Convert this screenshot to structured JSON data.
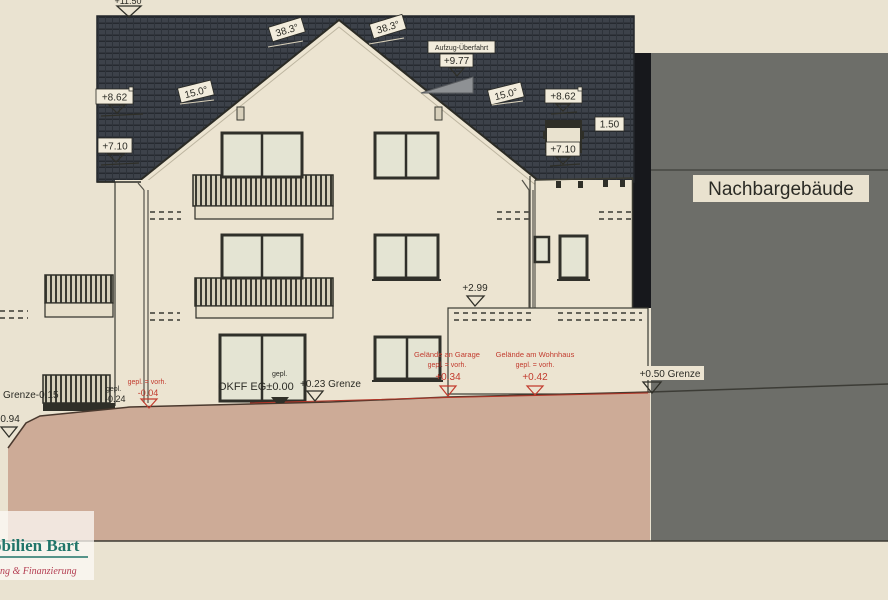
{
  "drawing_labels": {
    "ridge_level": "+11.50",
    "left_roof_level_upper": "+8.62",
    "left_roof_pitch": "15.0°",
    "left_roof_level_lower": "+7.10",
    "gable_angle_left": "38.3°",
    "gable_angle_right": "38.3°",
    "elevator_label": "Aufzug-Überfahrt",
    "elevator_level": "+9.77",
    "right_roof_pitch": "15.0°",
    "right_roof_level_upper": "+8.62",
    "right_roof_width": "1.50",
    "right_roof_level_lower": "+7.10",
    "neighbor_building": "Nachbargebäude",
    "garage_roof_level": "+2.99"
  },
  "ground_labels": {
    "boundary_left": "Grenze-0.15",
    "level_left_lower": "-0.94",
    "gepl_small": "gepl.",
    "level_terrace": "-0.24",
    "gepl_vorh_left": "gepl. = vorh.",
    "level_left_red": "-0.04",
    "okff_gepl": "gepl.",
    "okff": "OKFF EG±0.00",
    "boundary_mid": "+0.23 Grenze",
    "garage_caption": "Gelände an Garage",
    "garage_gepl_vorh": "gepl. = vorh.",
    "garage_level": "+0.34",
    "house_caption": "Gelände am Wohnhaus",
    "house_gepl_vorh": "gepl. = vorh.",
    "house_level": "+0.42",
    "boundary_right": "+0.50 Grenze"
  },
  "logo": {
    "name_fragment": "obilien Bart",
    "tagline_fragment": "ung & Finanzierung"
  },
  "colors": {
    "roof": "#3d424a",
    "terrain": "#cdab97",
    "neighbor_building": "#6d6e69",
    "wall": "#ece4d1",
    "background": "#eae3d1",
    "annotation_red": "#c23b2e",
    "logo_teal": "#20756a",
    "logo_red": "#b43e52"
  }
}
